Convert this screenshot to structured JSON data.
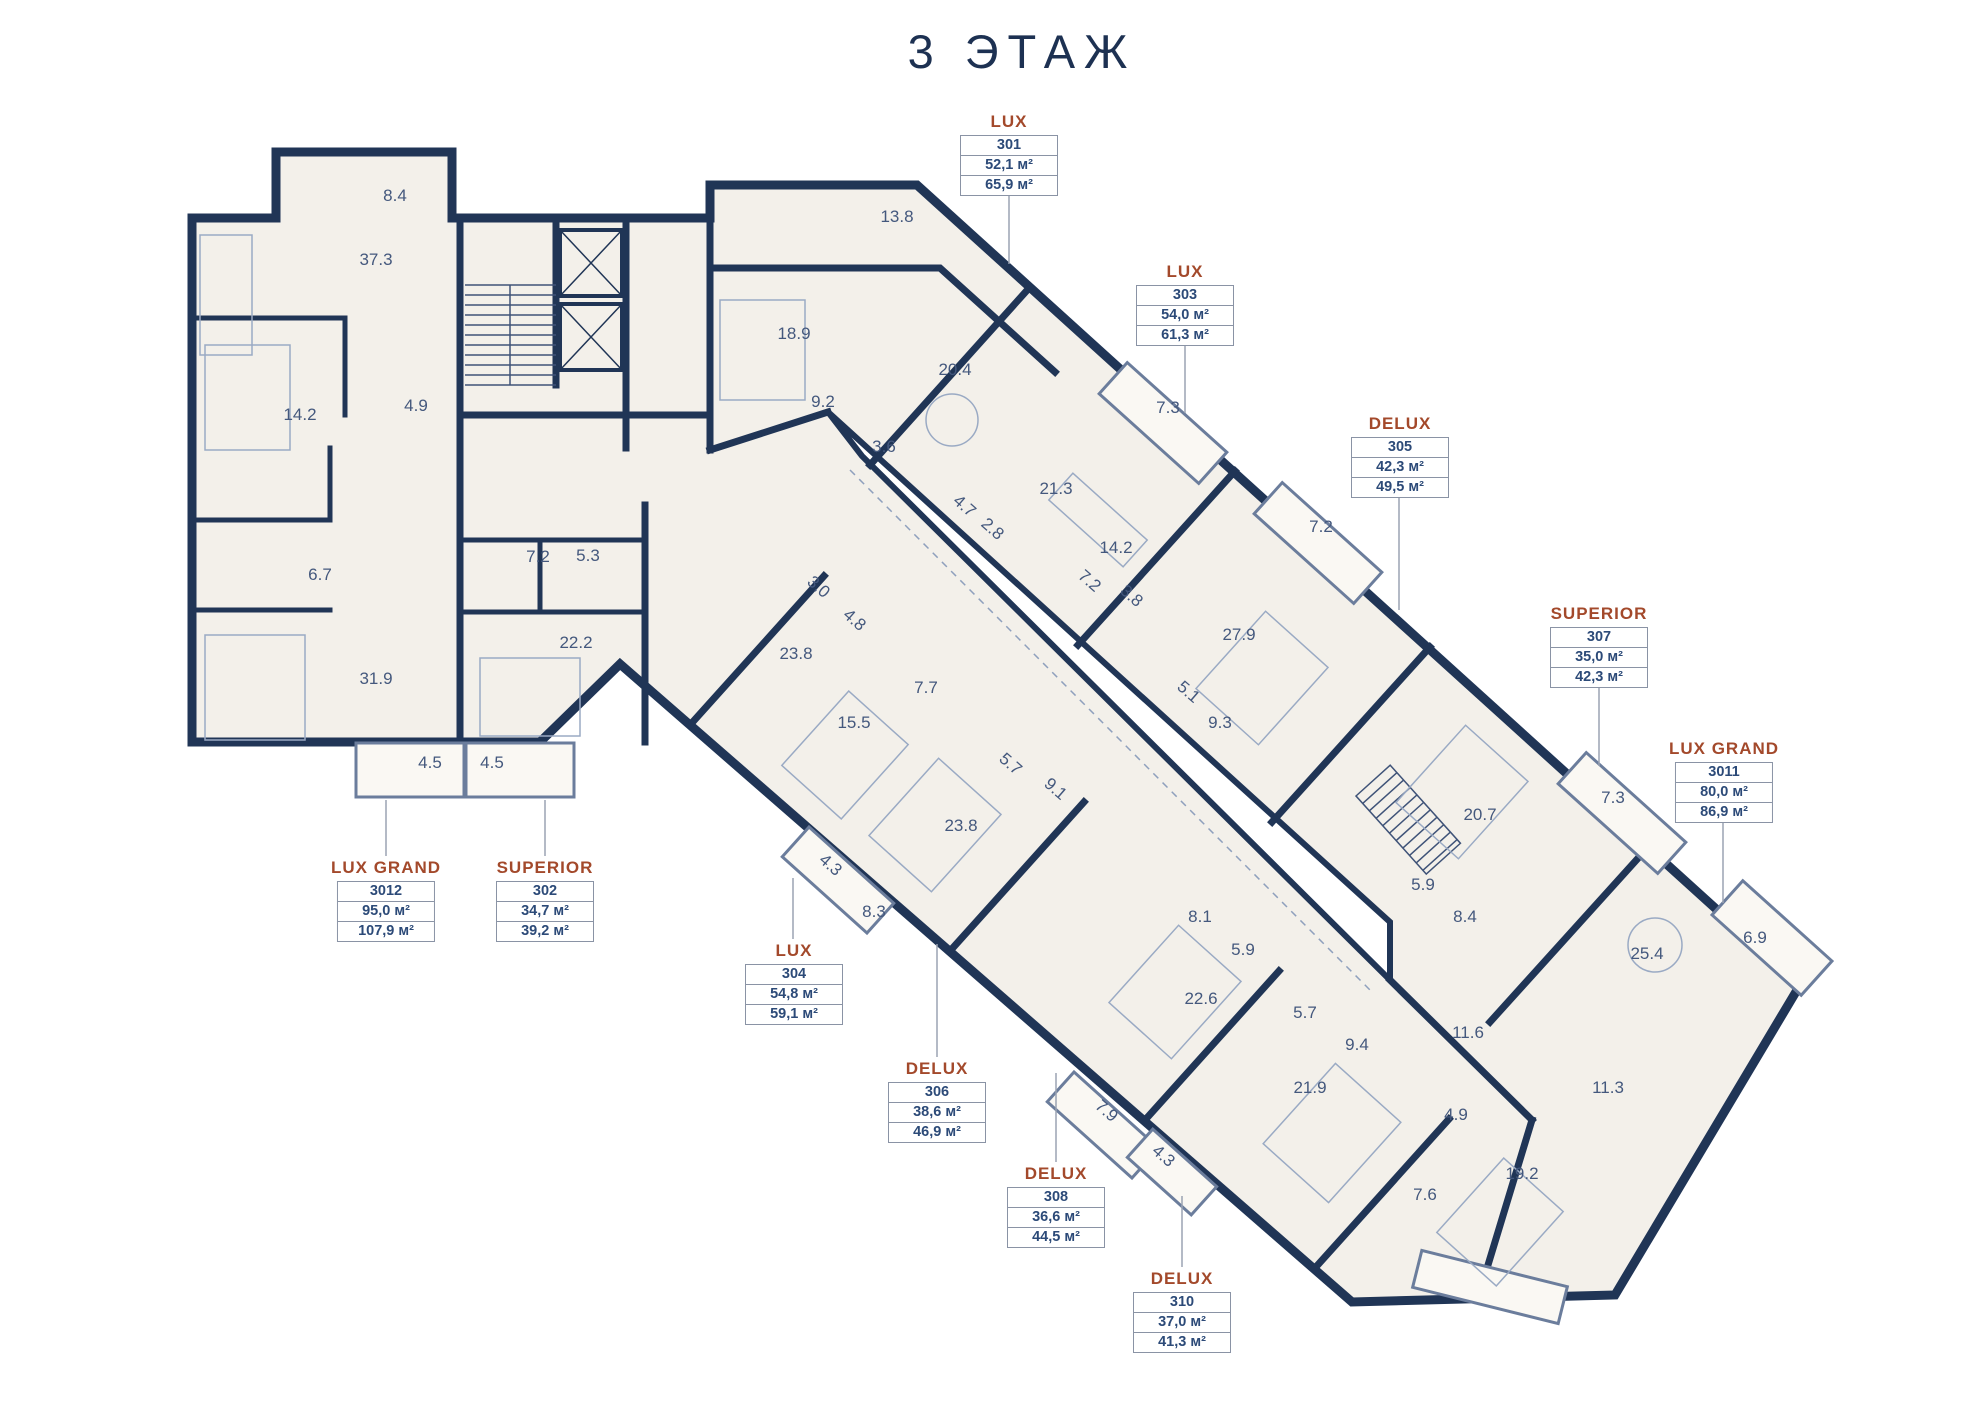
{
  "title": "3 ЭТАЖ",
  "colors": {
    "walls_navy": "#203556",
    "title_navy": "#1d3152",
    "accent_brown": "#a3492b",
    "floor_fill": "#f3f0ea",
    "room_number_text": "#44587d",
    "leader_line": "#9aa3b2",
    "label_box_border": "#8a93a5",
    "label_value_text": "#2c4a78"
  },
  "units": [
    {
      "type": "LUX",
      "number": "301",
      "area1": "52,1 м²",
      "area2": "65,9 м²",
      "label": {
        "x": 1009,
        "y": 112
      },
      "leader": {
        "x": 1009,
        "y1": 196,
        "y2": 264
      }
    },
    {
      "type": "LUX",
      "number": "303",
      "area1": "54,0 м²",
      "area2": "61,3 м²",
      "label": {
        "x": 1185,
        "y": 262
      },
      "leader": {
        "x": 1185,
        "y1": 346,
        "y2": 413
      }
    },
    {
      "type": "DELUX",
      "number": "305",
      "area1": "42,3 м²",
      "area2": "49,5 м²",
      "label": {
        "x": 1400,
        "y": 414
      },
      "leader": {
        "x": 1399,
        "y1": 498,
        "y2": 610
      }
    },
    {
      "type": "SUPERIOR",
      "number": "307",
      "area1": "35,0 м²",
      "area2": "42,3 м²",
      "label": {
        "x": 1599,
        "y": 604
      },
      "leader": {
        "x": 1599,
        "y1": 688,
        "y2": 766
      }
    },
    {
      "type": "LUX GRAND",
      "number": "3011",
      "area1": "80,0 м²",
      "area2": "86,9 м²",
      "label": {
        "x": 1724,
        "y": 739
      },
      "leader": {
        "x": 1723,
        "y1": 823,
        "y2": 903
      }
    },
    {
      "type": "LUX GRAND",
      "number": "3012",
      "area1": "95,0 м²",
      "area2": "107,9 м²",
      "label": {
        "x": 386,
        "y": 858
      },
      "leader": {
        "x": 386,
        "y1": 856,
        "y2": 800
      }
    },
    {
      "type": "SUPERIOR",
      "number": "302",
      "area1": "34,7 м²",
      "area2": "39,2 м²",
      "label": {
        "x": 545,
        "y": 858
      },
      "leader": {
        "x": 545,
        "y1": 856,
        "y2": 800
      }
    },
    {
      "type": "LUX",
      "number": "304",
      "area1": "54,8 м²",
      "area2": "59,1 м²",
      "label": {
        "x": 794,
        "y": 941
      },
      "leader": {
        "x": 793,
        "y1": 939,
        "y2": 878
      }
    },
    {
      "type": "DELUX",
      "number": "306",
      "area1": "38,6 м²",
      "area2": "46,9 м²",
      "label": {
        "x": 937,
        "y": 1059
      },
      "leader": {
        "x": 937,
        "y1": 1057,
        "y2": 944
      }
    },
    {
      "type": "DELUX",
      "number": "308",
      "area1": "36,6 м²",
      "area2": "44,5 м²",
      "label": {
        "x": 1056,
        "y": 1164
      },
      "leader": {
        "x": 1056,
        "y1": 1162,
        "y2": 1073
      }
    },
    {
      "type": "DELUX",
      "number": "310",
      "area1": "37,0 м²",
      "area2": "41,3 м²",
      "label": {
        "x": 1182,
        "y": 1269
      },
      "leader": {
        "x": 1182,
        "y1": 1267,
        "y2": 1196
      }
    }
  ],
  "rooms": [
    {
      "v": "8.4",
      "x": 395,
      "y": 201
    },
    {
      "v": "37.3",
      "x": 376,
      "y": 265
    },
    {
      "v": "14.2",
      "x": 300,
      "y": 420
    },
    {
      "v": "4.9",
      "x": 416,
      "y": 411
    },
    {
      "v": "6.7",
      "x": 320,
      "y": 580
    },
    {
      "v": "31.9",
      "x": 376,
      "y": 684
    },
    {
      "v": "4.5",
      "x": 430,
      "y": 768
    },
    {
      "v": "4.5",
      "x": 492,
      "y": 768
    },
    {
      "v": "7.2",
      "x": 538,
      "y": 562
    },
    {
      "v": "5.3",
      "x": 588,
      "y": 561
    },
    {
      "v": "22.2",
      "x": 576,
      "y": 648
    },
    {
      "v": "13.8",
      "x": 897,
      "y": 222
    },
    {
      "v": "18.9",
      "x": 794,
      "y": 339
    },
    {
      "v": "9.2",
      "x": 823,
      "y": 407
    },
    {
      "v": "20.4",
      "x": 955,
      "y": 375
    },
    {
      "v": "3.6",
      "x": 884,
      "y": 452
    },
    {
      "v": "7.3",
      "x": 1168,
      "y": 413
    },
    {
      "v": "21.3",
      "x": 1056,
      "y": 494
    },
    {
      "v": "4.7",
      "x": 961,
      "y": 510,
      "r": 41
    },
    {
      "v": "2.8",
      "x": 989,
      "y": 533,
      "r": 41
    },
    {
      "v": "14.2",
      "x": 1116,
      "y": 553
    },
    {
      "v": "7.2",
      "x": 1086,
      "y": 585,
      "r": 41
    },
    {
      "v": "3.8",
      "x": 1128,
      "y": 600,
      "r": 41
    },
    {
      "v": "7.2",
      "x": 1321,
      "y": 532
    },
    {
      "v": "27.9",
      "x": 1239,
      "y": 640
    },
    {
      "v": "5.1",
      "x": 1185,
      "y": 696,
      "r": 41
    },
    {
      "v": "9.3",
      "x": 1220,
      "y": 728
    },
    {
      "v": "3.0",
      "x": 815,
      "y": 591,
      "r": 41
    },
    {
      "v": "4.8",
      "x": 851,
      "y": 624,
      "r": 41
    },
    {
      "v": "23.8",
      "x": 796,
      "y": 659
    },
    {
      "v": "7.7",
      "x": 926,
      "y": 693
    },
    {
      "v": "15.5",
      "x": 854,
      "y": 728
    },
    {
      "v": "5.7",
      "x": 1007,
      "y": 768,
      "r": 41
    },
    {
      "v": "9.1",
      "x": 1052,
      "y": 793,
      "r": 41
    },
    {
      "v": "23.8",
      "x": 961,
      "y": 831
    },
    {
      "v": "4.3",
      "x": 827,
      "y": 869,
      "r": 41
    },
    {
      "v": "8.3",
      "x": 874,
      "y": 917
    },
    {
      "v": "8.1",
      "x": 1200,
      "y": 922
    },
    {
      "v": "5.9",
      "x": 1243,
      "y": 955
    },
    {
      "v": "22.6",
      "x": 1201,
      "y": 1004
    },
    {
      "v": "7.9",
      "x": 1103,
      "y": 1115,
      "r": 41
    },
    {
      "v": "4.3",
      "x": 1160,
      "y": 1160,
      "r": 41
    },
    {
      "v": "5.7",
      "x": 1305,
      "y": 1018
    },
    {
      "v": "9.4",
      "x": 1357,
      "y": 1050
    },
    {
      "v": "21.9",
      "x": 1310,
      "y": 1093
    },
    {
      "v": "20.7",
      "x": 1480,
      "y": 820
    },
    {
      "v": "7.3",
      "x": 1613,
      "y": 803
    },
    {
      "v": "5.9",
      "x": 1423,
      "y": 890
    },
    {
      "v": "8.4",
      "x": 1465,
      "y": 922
    },
    {
      "v": "6.9",
      "x": 1755,
      "y": 943
    },
    {
      "v": "25.4",
      "x": 1647,
      "y": 959
    },
    {
      "v": "11.6",
      "x": 1468,
      "y": 1038
    },
    {
      "v": "11.3",
      "x": 1608,
      "y": 1093
    },
    {
      "v": "4.9",
      "x": 1456,
      "y": 1120
    },
    {
      "v": "19.2",
      "x": 1522,
      "y": 1179
    },
    {
      "v": "7.6",
      "x": 1425,
      "y": 1200
    }
  ]
}
